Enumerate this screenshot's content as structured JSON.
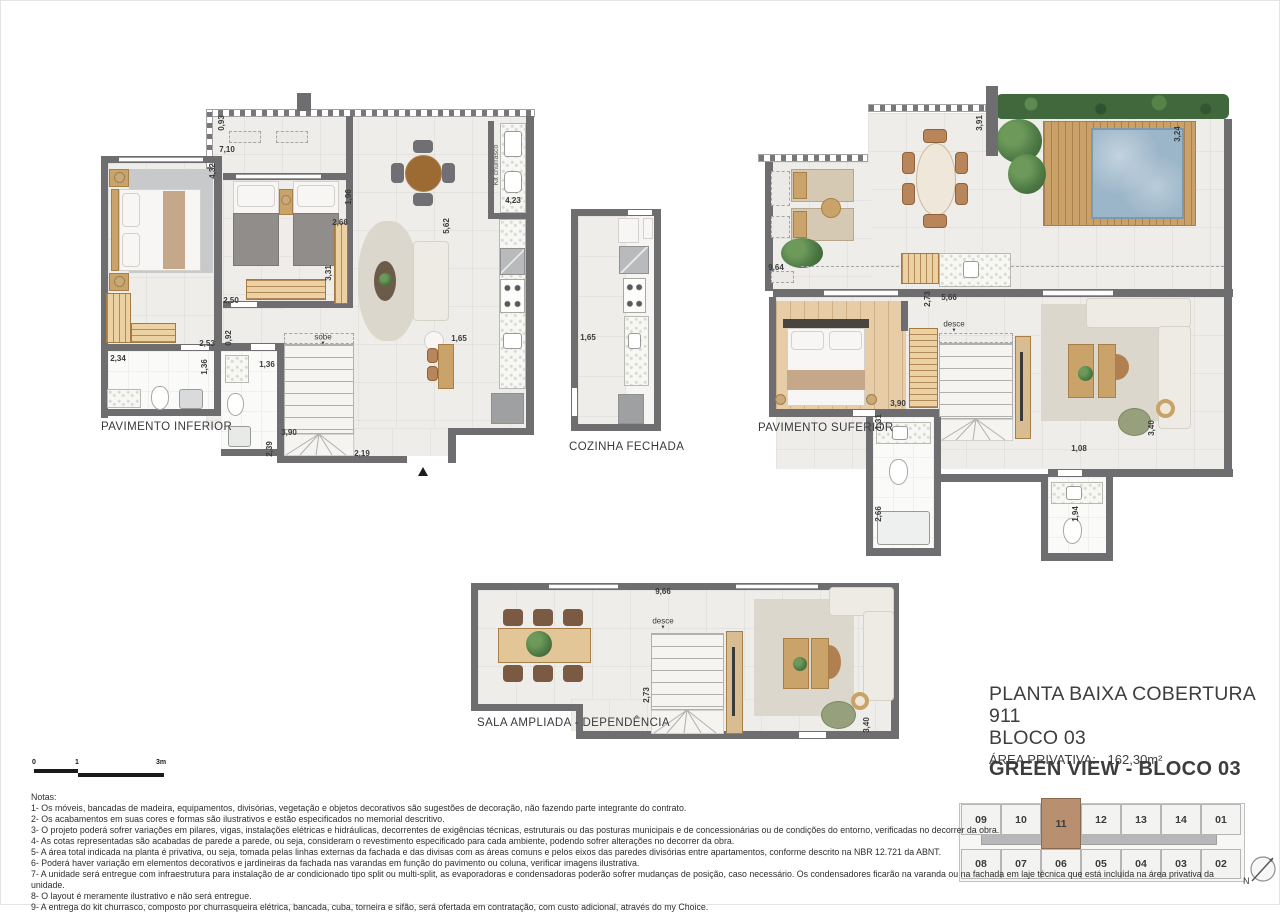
{
  "document": {
    "title_block": {
      "line1": "PLANTA BAIXA COBERTURA 911",
      "line2": "BLOCO 03",
      "area_label": "ÁREA PRIVATIVA:",
      "area_value": "162,30m²"
    },
    "project_title": "GREEN VIEW  -  BLOCO 03",
    "north_label": "N",
    "scale_bar": {
      "t0": "0",
      "t1": "1",
      "t2": "3m"
    },
    "notes_heading": "Notas:",
    "notes": [
      "1- Os móveis, bancadas de madeira, equipamentos, divisórias, vegetação e objetos decorativos são sugestões de decoração, não fazendo parte integrante do contrato.",
      "2- Os acabamentos em suas cores e formas são ilustrativos e estão especificados no memorial descritivo.",
      "3- O projeto poderá sofrer variações em pilares, vigas, instalações elétricas e hidráulicas, decorrentes de exigências técnicas, estruturais ou das posturas municipais e de concessionárias ou de condições do entorno, verificadas no decorrer da obra.",
      "4- As cotas representadas são acabadas de parede a parede, ou seja, consideram o revestimento especificado para cada ambiente, podendo sofrer alterações no decorrer da obra.",
      "5- A área total indicada na planta é privativa, ou seja, tomada pelas linhas externas da fachada e das divisas com as áreas comuns e pelos eixos das paredes divisórias entre apartamentos, conforme descrito na NBR 12.721 da ABNT.",
      "6- Poderá haver variação em elementos decorativos e jardineiras da fachada nas varandas em função do pavimento ou coluna, verificar imagens ilustrativa.",
      "7- A unidade será entregue com infraestrutura para instalação de ar condicionado tipo split ou multi-split, as evaporadoras e condensadoras poderão sofrer mudanças de posição, caso necessário. Os condensadores ficarão na varanda ou na fachada em laje técnica que está incluída na área privativa da unidade.",
      "8- O layout é meramente ilustrativo e não será entregue.",
      "9- A entrega do kit churrasco, composto por churrasqueira elétrica, bancada, cuba, torneira e sifão, será ofertada em contratação, com custo adicional, através do my Choice."
    ]
  },
  "plans": {
    "inferior": {
      "label": "PAVIMENTO INFERIOR",
      "dims": [
        {
          "t": "0,93",
          "x": 121,
          "y": 30,
          "r": 1
        },
        {
          "t": "7,10",
          "x": 126,
          "y": 57
        },
        {
          "t": "4,32",
          "x": 112,
          "y": 78,
          "r": 1
        },
        {
          "t": "1,96",
          "x": 248,
          "y": 104,
          "r": 1
        },
        {
          "t": "2,66",
          "x": 239,
          "y": 130
        },
        {
          "t": "3,31",
          "x": 228,
          "y": 180,
          "r": 1
        },
        {
          "t": "2,50",
          "x": 130,
          "y": 208
        },
        {
          "t": "5,62",
          "x": 346,
          "y": 133,
          "r": 1
        },
        {
          "t": "1,65",
          "x": 358,
          "y": 246
        },
        {
          "t": "2,53",
          "x": 106,
          "y": 251
        },
        {
          "t": "0,92",
          "x": 128,
          "y": 245,
          "r": 1
        },
        {
          "t": "1,36",
          "x": 104,
          "y": 274,
          "r": 1
        },
        {
          "t": "1,36",
          "x": 166,
          "y": 272
        },
        {
          "t": "2,34",
          "x": 17,
          "y": 266
        },
        {
          "t": "3,90",
          "x": 188,
          "y": 340
        },
        {
          "t": "2,39",
          "x": 169,
          "y": 356,
          "r": 1
        },
        {
          "t": "2,19",
          "x": 261,
          "y": 361
        },
        {
          "t": "4,23",
          "x": 412,
          "y": 108
        },
        {
          "t": "sobe",
          "x": 222,
          "y": 247,
          "a": 1
        },
        {
          "t": "Kit churrasco",
          "x": 396,
          "y": 72,
          "r": 1,
          "s": 1
        }
      ]
    },
    "cozinha": {
      "label": "COZINHA FECHADA",
      "dims": [
        {
          "t": "1,65",
          "x": 22,
          "y": 142
        }
      ]
    },
    "superior": {
      "label": "PAVIMENTO SUFERIOR",
      "dims": [
        {
          "t": "3,91",
          "x": 222,
          "y": 37,
          "r": 1
        },
        {
          "t": "3,24",
          "x": 420,
          "y": 48,
          "r": 1
        },
        {
          "t": "9,64",
          "x": 18,
          "y": 182
        },
        {
          "t": "2,73",
          "x": 170,
          "y": 213,
          "r": 1
        },
        {
          "t": "5,66",
          "x": 191,
          "y": 212
        },
        {
          "t": "3,90",
          "x": 140,
          "y": 318
        },
        {
          "t": "1,31",
          "x": 121,
          "y": 336,
          "r": 1
        },
        {
          "t": "2,66",
          "x": 121,
          "y": 428,
          "r": 1
        },
        {
          "t": "1,08",
          "x": 321,
          "y": 363
        },
        {
          "t": "1,94",
          "x": 318,
          "y": 428,
          "r": 1
        },
        {
          "t": "3,40",
          "x": 394,
          "y": 342,
          "r": 1
        },
        {
          "t": "desce",
          "x": 196,
          "y": 241,
          "a": 1
        }
      ]
    },
    "sala": {
      "label": "SALA  AMPLIADA - DEPENDÊNCIA",
      "dims": [
        {
          "t": "9,66",
          "x": 192,
          "y": 13
        },
        {
          "t": "2,73",
          "x": 176,
          "y": 116,
          "r": 1
        },
        {
          "t": "3,40",
          "x": 396,
          "y": 146,
          "r": 1
        },
        {
          "t": "desce",
          "x": 192,
          "y": 45,
          "a": 1
        }
      ]
    }
  },
  "key_plan": {
    "top_row": [
      "09",
      "10",
      "11",
      "12",
      "13",
      "14",
      "01"
    ],
    "bottom_row": [
      "08",
      "07",
      "06",
      "05",
      "04",
      "03",
      "02"
    ],
    "highlighted": "11"
  },
  "colors": {
    "wall": "#6e6e71",
    "floor": "#efedea",
    "wood": "#c9a169",
    "pool": "#9cb6c9",
    "hedge": "#41673c",
    "highlight_unit": "#b9906f"
  }
}
